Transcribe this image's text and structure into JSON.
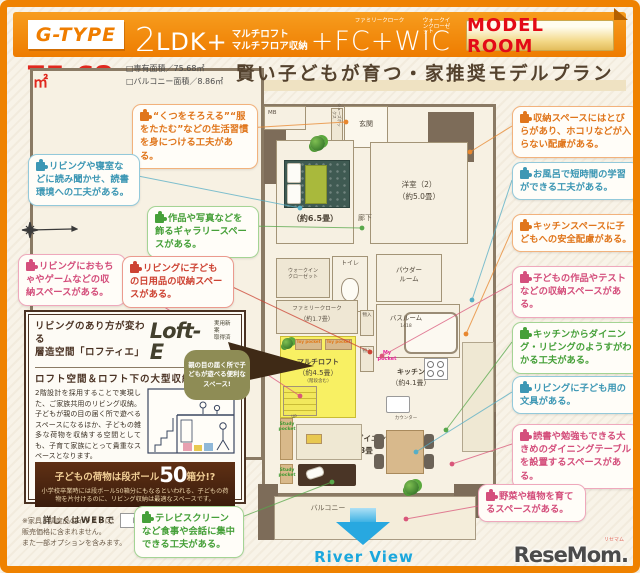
{
  "header": {
    "type_label": "G-TYPE",
    "plan_num": "2",
    "plan_ldk": "LDK+",
    "plan_extra_line1": "マルチロフト",
    "plan_extra_line2": "マルチフロア収納",
    "fc_wic": "+FC+WIC",
    "fc_ruby": "ファミリークローク",
    "wic_ruby": "ウォークインクローゼット",
    "model_room": "MODEL ROOM"
  },
  "area": {
    "size": "75.68",
    "unit": "㎡",
    "legend": "□専有面積／75.68㎡\n□バルコニー面積／8.86㎡"
  },
  "title": "賢い子どもが育つ・家推奨モデルプラン",
  "callouts": {
    "left": [
      {
        "id": "habit",
        "color": "#e0761c",
        "text": "“くつをそろえる”“服をたたむ”などの生活習慣を身につける工夫がある。"
      },
      {
        "id": "reading",
        "color": "#3d97b4",
        "text": "リビングや寝室などに読み聞かせ、読書環境への工夫がある。"
      },
      {
        "id": "gallery",
        "color": "#46a039",
        "text": "作品や写真などを飾るギャラリースペースがある。"
      },
      {
        "id": "toys",
        "color": "#d44f7c",
        "text": "リビングにおもちゃやゲームなどの収納スペースがある。"
      },
      {
        "id": "daily-goods",
        "color": "#cd4333",
        "text": "リビングに子どもの日用品の収納スペースがある。"
      },
      {
        "id": "tv-screen",
        "color": "#46a039",
        "text": "テレビスクリーンなど食事や会話に集中できる工夫がある。"
      }
    ],
    "right": [
      {
        "id": "storage-doors",
        "color": "#e0761c",
        "text": "収納スペースにはとびらがあり、ホコリなどが入らない配慮がある。"
      },
      {
        "id": "bath-study",
        "color": "#3d97b4",
        "text": "お風呂で短時間の学習ができる工夫がある。"
      },
      {
        "id": "kitchen-safety",
        "color": "#e0761c",
        "text": "キッチンスペースに子どもへの安全配慮がある。"
      },
      {
        "id": "works-storage",
        "color": "#d44f7c",
        "text": "子どもの作品やテストなどの収納スペースがある。"
      },
      {
        "id": "kitchen-view",
        "color": "#46a039",
        "text": "キッチンからダイニング・リビングのようすがわかる工夫がある。"
      },
      {
        "id": "stationery",
        "color": "#3d97b4",
        "text": "リビングに子ども用の文具がある。"
      },
      {
        "id": "dining-table",
        "color": "#d44f7c",
        "text": "読書や勉強もできる大きめのダイニングテーブルを設置するスペースがある。"
      },
      {
        "id": "plants",
        "color": "#d44f7c",
        "text": "野菜や植物を育てるスペースがある。"
      }
    ]
  },
  "lofte": {
    "heading": "リビングのあり方が変わる\n層造空間「ロフティエ」",
    "logo": "Loft-E",
    "patent": "実用新案\n取得済",
    "subtitle": "ロフト空間＆ロフト下の大型収納。",
    "body": "2階設計を採用することで実現した、ご家族共用のリビング収納。子どもが親の目の届く所で遊べるスペースになるほか、子どもの雑多な荷物を収納する空間としても、子育て家族にとって貴重なスペースとなります。",
    "badge": "親の目の届く所で子どもが遊べる便利なスペース!",
    "banner_pre": "子どもの荷物は段ボール",
    "banner_num": "50",
    "banner_post": "箱分!?",
    "banner_body": "小学校卒業時には段ボール50箱分にもなるといわれる、子どもの荷物を片付けるのに、リビング収納は最適なスペースです。",
    "web_label": "詳しくはWEBで",
    "search_value": "ロフティエ",
    "search_button": "検索"
  },
  "floorplan": {
    "mb": "MB",
    "entrance": "玄関",
    "shoe_box": "シューズボックス",
    "bedroom_size": "（約6.5畳）",
    "western_room": "洋室（2）",
    "western_room_size": "（約5.0畳）",
    "hallway": "廊下",
    "wic": "ウォークイン\nクローゼット",
    "toilet": "トイレ",
    "powder": "パウダー\nルーム",
    "bath": "バスルーム",
    "bath_size": "1418",
    "family_cloak": "ファミリークローク",
    "family_cloak_size": "（約1.7畳）",
    "multi_loft": "マルチロフト",
    "multi_loft_size": "（約4.5畳）",
    "multi_loft_note": "（階段含む）",
    "storage1": "物入",
    "storage2": "物入",
    "toy_pocket": "Toy pocket",
    "my_pocket": "My\npocket",
    "study_pocket": "Study\npocket",
    "kitchen": "キッチン",
    "kitchen_size": "（約4.1畳）",
    "counter": "カウンター",
    "living": "リビング・ダイニング",
    "living_size": "約13.3畳",
    "balcony": "バルコニー",
    "river_view": "River View",
    "up": "UP"
  },
  "footer": {
    "note": "※家具・調度品のイラストは、\n販売価格に含まれません。\nまた一部オプションを含みます。",
    "logo": "ReseMom.",
    "logo_ruby": "リセマム"
  },
  "icons": {
    "puzzle": "puzzle-piece",
    "compass": "north-compass",
    "cursor": "pointer-arrow",
    "river_arrow": "down-arrow"
  },
  "palette": {
    "frame_orange": "#ef8200",
    "accent_red": "#e0281e",
    "title_brown": "#54422e",
    "wall_brown": "#7d6c59",
    "loft_yellow": "#f8f063",
    "river_blue": "#1ba7dd",
    "banner_brown": "#3a1c0c",
    "badge_olive": "#8e8c55"
  }
}
